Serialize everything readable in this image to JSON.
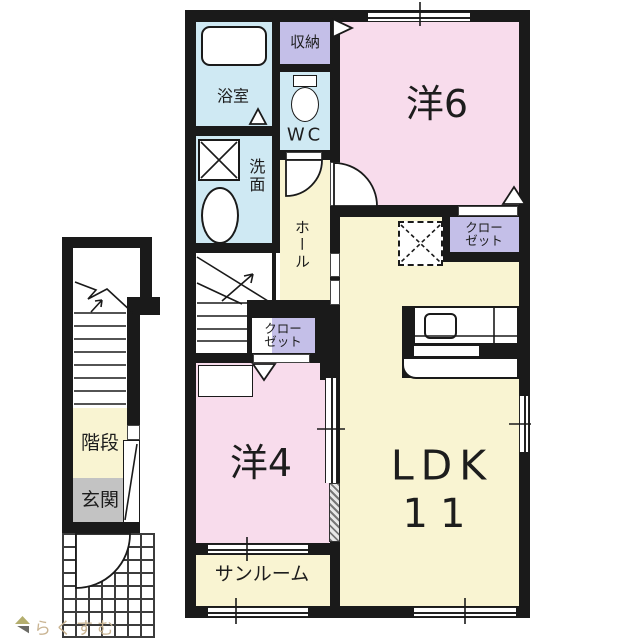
{
  "colors": {
    "wall": "#1a1a1a",
    "room_pink": "#f8dcec",
    "room_cream": "#f9f4d2",
    "room_blue": "#cfe9f3",
    "room_lavender": "#c4bfe8",
    "room_gray": "#c3c3c3",
    "watermark_text": "#c9b492"
  },
  "labels": {
    "bath": "浴室",
    "storage": "収納",
    "wc": "WC",
    "washroom": "洗面",
    "hall": "ホール",
    "western6": "洋6",
    "western4": "洋4",
    "sunroom": "サンルーム",
    "ldk": "LDK",
    "ldk_size": "11",
    "stairs": "階段",
    "entrance": "玄関",
    "closet_yo6": {
      "line1": "クロー",
      "line2": "ゼット"
    },
    "closet_yo4": {
      "line1": "クロー",
      "line2": "ゼット"
    }
  },
  "watermark": {
    "text": "らくすむ"
  }
}
